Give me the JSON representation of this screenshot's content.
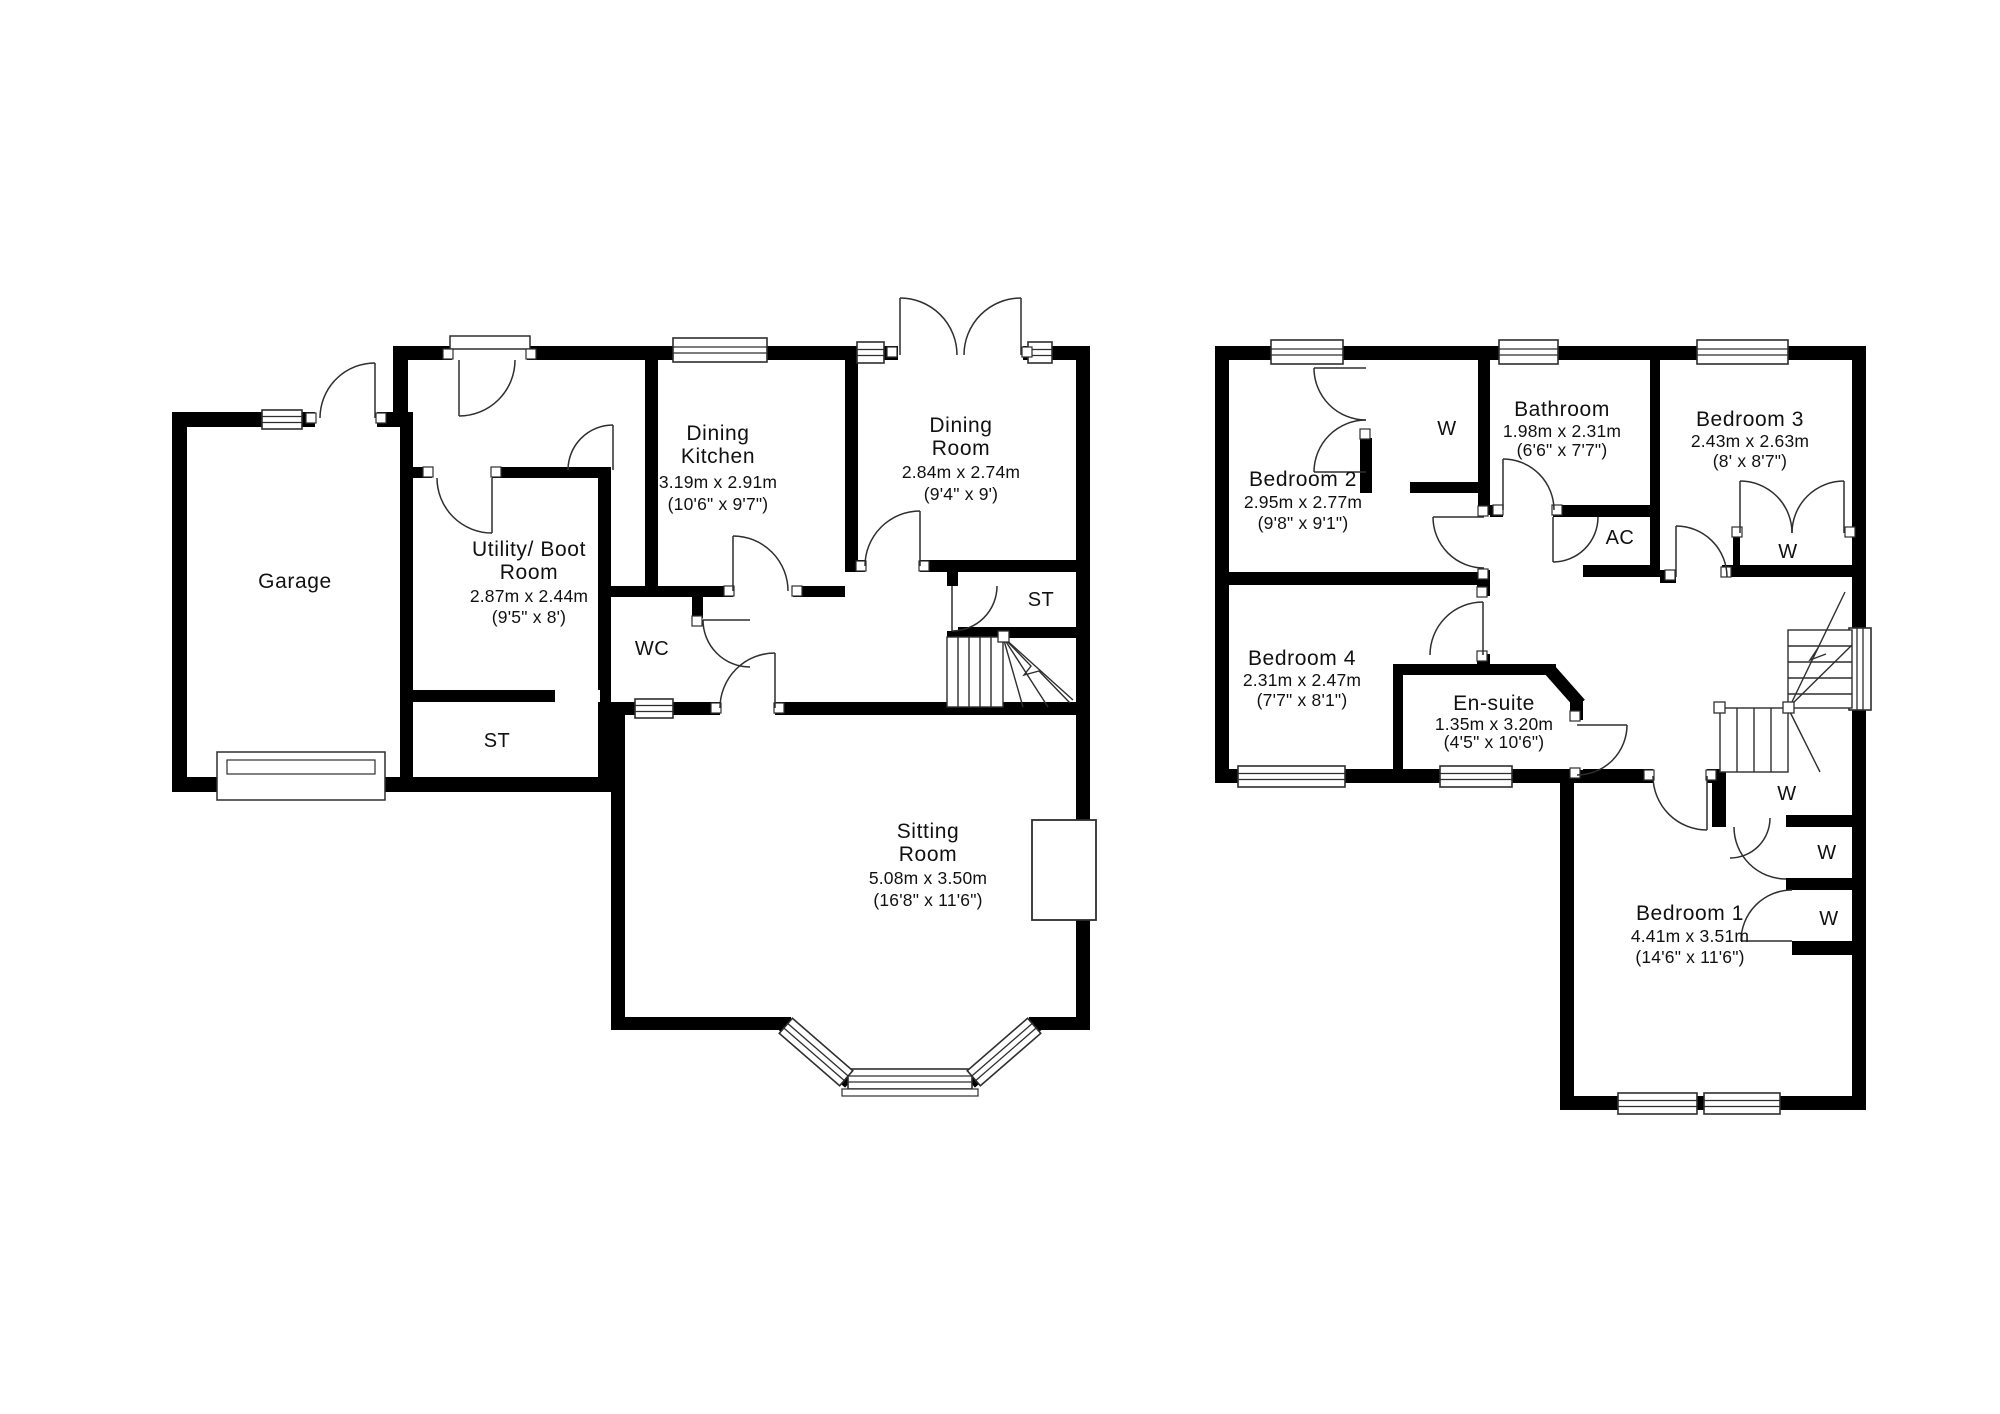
{
  "meta": {
    "type": "floor-plan",
    "floor_count": 2
  },
  "colors": {
    "wall": "#000000",
    "background": "#ffffff",
    "line": "#2e2e2e",
    "text": "#111111"
  },
  "ground_floor": {
    "rooms": [
      {
        "id": "garage",
        "name_lines": [
          "Garage"
        ]
      },
      {
        "id": "utility",
        "name_lines": [
          "Utility/ Boot",
          "Room"
        ],
        "dims_m": "2.87m x 2.44m",
        "dims_ft": "(9'5\" x 8')"
      },
      {
        "id": "dining-kitchen",
        "name_lines": [
          "Dining",
          "Kitchen"
        ],
        "dims_m": "3.19m x 2.91m",
        "dims_ft": "(10'6\" x 9'7\")"
      },
      {
        "id": "dining-room",
        "name_lines": [
          "Dining",
          "Room"
        ],
        "dims_m": "2.84m x 2.74m",
        "dims_ft": "(9'4\" x 9')"
      },
      {
        "id": "sitting-room",
        "name_lines": [
          "Sitting",
          "Room"
        ],
        "dims_m": "5.08m x 3.50m",
        "dims_ft": "(16'8\" x 11'6\")"
      },
      {
        "id": "wc",
        "name_lines": [
          "WC"
        ]
      },
      {
        "id": "st-stairs",
        "name_lines": [
          "ST"
        ]
      },
      {
        "id": "st-store",
        "name_lines": [
          "ST"
        ]
      }
    ]
  },
  "first_floor": {
    "rooms": [
      {
        "id": "bedroom-2",
        "name_lines": [
          "Bedroom 2"
        ],
        "dims_m": "2.95m x 2.77m",
        "dims_ft": "(9'8\" x 9'1\")"
      },
      {
        "id": "bathroom",
        "name_lines": [
          "Bathroom"
        ],
        "dims_m": "1.98m x 2.31m",
        "dims_ft": "(6'6\" x 7'7\")"
      },
      {
        "id": "bedroom-3",
        "name_lines": [
          "Bedroom 3"
        ],
        "dims_m": "2.43m x 2.63m",
        "dims_ft": "(8' x 8'7\")"
      },
      {
        "id": "bedroom-4",
        "name_lines": [
          "Bedroom 4"
        ],
        "dims_m": "2.31m x 2.47m",
        "dims_ft": "(7'7\" x 8'1\")"
      },
      {
        "id": "en-suite",
        "name_lines": [
          "En-suite"
        ],
        "dims_m": "1.35m x 3.20m",
        "dims_ft": "(4'5\" x 10'6\")"
      },
      {
        "id": "bedroom-1",
        "name_lines": [
          "Bedroom 1"
        ],
        "dims_m": "4.41m x 3.51m",
        "dims_ft": "(14'6\" x 11'6\")"
      },
      {
        "id": "wardrobe-bedroom-2",
        "name_lines": [
          "W"
        ]
      },
      {
        "id": "wardrobe-bedroom-3",
        "name_lines": [
          "W"
        ]
      },
      {
        "id": "airing-cupboard",
        "name_lines": [
          "AC"
        ]
      },
      {
        "id": "wardrobe-1-bedroom-1",
        "name_lines": [
          "W"
        ]
      },
      {
        "id": "wardrobe-2-bedroom-1",
        "name_lines": [
          "W"
        ]
      },
      {
        "id": "wardrobe-3-bedroom-1",
        "name_lines": [
          "W"
        ]
      }
    ]
  }
}
